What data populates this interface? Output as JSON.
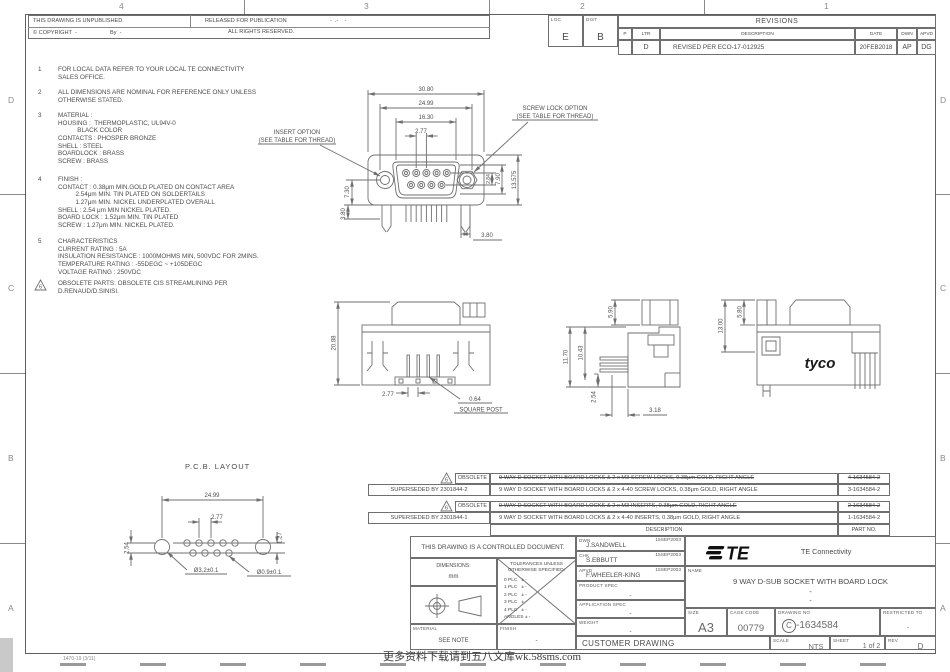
{
  "zones": {
    "top": [
      "4",
      "3",
      "2",
      "1"
    ],
    "side": [
      "D",
      "C",
      "B",
      "A"
    ]
  },
  "header": {
    "unpublished": "THIS DRAWING IS UNPUBLISHED.",
    "released": "RELEASED FOR PUBLICATION",
    "released_date": "-  .-    -",
    "copyright": "© COPYRIGHT  -",
    "by": "By  -",
    "rights": "ALL RIGHTS RESERVED."
  },
  "revisions": {
    "loc_label": "LOC",
    "loc_value": "E",
    "dist_label": "DIST",
    "dist_value": "B",
    "title": "REVISIONS",
    "col_p": "P",
    "col_ltr": "LTR",
    "col_desc": "DESCRIPTION",
    "col_date": "DATE",
    "col_dwn": "DWN",
    "col_apvd": "APVD",
    "row": {
      "ltr": "D",
      "desc": "REVISED PER ECO-17-012925",
      "date": "20FEB2018",
      "dwn": "AP",
      "apvd": "DG"
    }
  },
  "notes": [
    {
      "num": "1",
      "text": "FOR LOCAL DATA REFER TO YOUR LOCAL TE CONNECTIVITY\nSALES OFFICE."
    },
    {
      "num": "2",
      "text": "ALL DIMENSIONS ARE NOMINAL FOR REFERENCE ONLY UNLESS\nOTHERWISE STATED."
    },
    {
      "num": "3",
      "text": "MATERIAL :\nHOUSING :  THERMOPLASTIC, UL94V-0\n           BLACK COLOR\nCONTACTS : PHOSPER BRONZE\nSHELL : STEEL\nBOARDLOCK : BRASS\nSCREW : BRASS"
    },
    {
      "num": "4",
      "text": "FINISH :\nCONTACT : 0.38μm MIN.GOLD PLATED ON CONTACT AREA\n          2.54μm MIN. TIN PLATED ON SOLDERTAILS\n          1.27μm MIN. NICKEL UNDERPLATED OVERALL\nSHELL : 2.54 μm MIN NICKEL PLATED.\nBOARD LOCK : 1.52μm MIN. TIN PLATED\nSCREW : 1.27μm MIN. NICKEL PLATED."
    },
    {
      "num": "5",
      "text": "CHARACTERISTICS\nCURRENT RATING : 5A\nINSULATION RESISTANCE : 1000MOHMS MIN, 500VDC FOR 2MINS.\nTEMPERATURE RATING : -55DEGC ~ +105DEGC\nVOLTAGE RATING : 250VDC"
    },
    {
      "num": "6",
      "text": "OBSOLETE PARTS: OBSOLETE CIS STREAMLINING PER\nD.RENAUD/D.SINISI."
    }
  ],
  "fv": {
    "d3080": "30.80",
    "d2499": "24.99",
    "d1630": "16.30",
    "d277": "2.77",
    "screw1": "SCREW LOCK OPTION",
    "screw2": "(SEE TABLE FOR THREAD)",
    "insert1": "INSERT OPTION",
    "insert2": "(SEE TABLE FOR THREAD)",
    "d730": "7.30",
    "d284": "2.84",
    "d790": "7.90",
    "d13575": "13.575",
    "d380a": "3.80",
    "d380b": "3.80"
  },
  "sv": {
    "d2088": "20.88",
    "d277": "2.77",
    "d064": "0.64",
    "square_post": "SQUARE POST"
  },
  "xv": {
    "d590": "5.90",
    "d1170": "11.70",
    "d1043": "10.43",
    "d254": "2.54",
    "d318": "3.18"
  },
  "rv": {
    "d1300": "13.00",
    "d580": "5.80",
    "logo": "tyco"
  },
  "pcb": {
    "title": "P.C.B. LAYOUT",
    "d2499": "24.99",
    "d277": "2.77",
    "d127": "1.27",
    "d254": "2.54",
    "hole_big": "Ø3.2±0.1",
    "hole_small": "Ø0.9±0.1"
  },
  "parts_table": {
    "col_desc": "DESCRIPTION",
    "col_part": "PART NO.",
    "rows": [
      {
        "flag": "6",
        "status": "OBSOLETE",
        "left": "",
        "desc": "9 WAY D SOCKET WITH BOARD LOCKS & 2 x M3 SCREW LOCKS, 0.38μm GOLD, RIGHT ANGLE",
        "part": "4-1634584-2"
      },
      {
        "left": "SUPERSEDED BY 2301844-2",
        "desc": "9 WAY D SOCKET WITH BOARD LOCKS & 2 x 4-40 SCREW LOCKS, 0.38μm GOLD, RIGHT ANGLE",
        "part": "3-1634584-2"
      },
      {
        "flag": "6",
        "status": "OBSOLETE",
        "left": "",
        "desc": "9 WAY D SOCKET WITH BOARD LOCKS & 2 x M3 INSERTS, 0.38μm GOLD, RIGHT ANGLE",
        "part": "2-1634584-2"
      },
      {
        "left": "SUPERSEDED BY 2301844-1",
        "desc": "9 WAY D SOCKET WITH BOARD LOCKS & 2 x 4-40 INSERTS, 0.38μm GOLD, RIGHT ANGLE",
        "part": "1-1634584-2"
      }
    ]
  },
  "tb": {
    "controlled": "THIS DRAWING IS A CONTROLLED DOCUMENT.",
    "dims_label": "DIMENSIONS:",
    "dims_unit": "mm",
    "tol_label": "TOLERANCES UNLESS\nOTHERWISE SPECIFIED:",
    "tol0": "0 PLC",
    "tol1": "1 PLC",
    "tol2": "2 PLC",
    "tol3": "3 PLC",
    "tol4": "4 PLC",
    "tol5": "ANGLES",
    "tolv": "± -",
    "material_label": "MATERIAL",
    "material": "SEE NOTE",
    "finish_label": "FINISH",
    "finish": "-",
    "dwn_label": "DWN",
    "dwn": "J.SANDWELL",
    "dwn_date": "15SEP2003",
    "chk_label": "CHK",
    "chk": "S.EBBUTT",
    "chk_date": "15SEP2003",
    "apvd_label": "APVD",
    "apvd": "F.WHEELER-KING",
    "apvd_date": "15SEP2003",
    "pspec_label": "PRODUCT SPEC",
    "pspec": "-",
    "aspec_label": "APPLICATION SPEC",
    "aspec": "-",
    "weight_label": "WEIGHT",
    "weight": "-",
    "customer": "CUSTOMER DRAWING",
    "logo_text": "TE",
    "brand": "TE Connectivity",
    "name_label": "NAME",
    "name": "9 WAY D-SUB SOCKET WITH BOARD LOCK",
    "name_sub1": "-",
    "name_sub2": "-",
    "size_label": "SIZE",
    "size": "A3",
    "cage_label": "CAGE CODE",
    "cage": "00779",
    "dwg_label": "DRAWING NO",
    "dwg_prefix": "C",
    "dwg_no": "-1634584",
    "restricted_label": "RESTRICTED TO",
    "restricted": "-",
    "scale_label": "SCALE",
    "scale": "NTS",
    "sheet_label": "SHEET",
    "sheet": "1 of 2",
    "rev_label": "REV",
    "rev": "D"
  },
  "footer": {
    "form": "1470-19 (3/11)",
    "watermark": "更多资料下载请到五八文库wk.58sms.com"
  }
}
